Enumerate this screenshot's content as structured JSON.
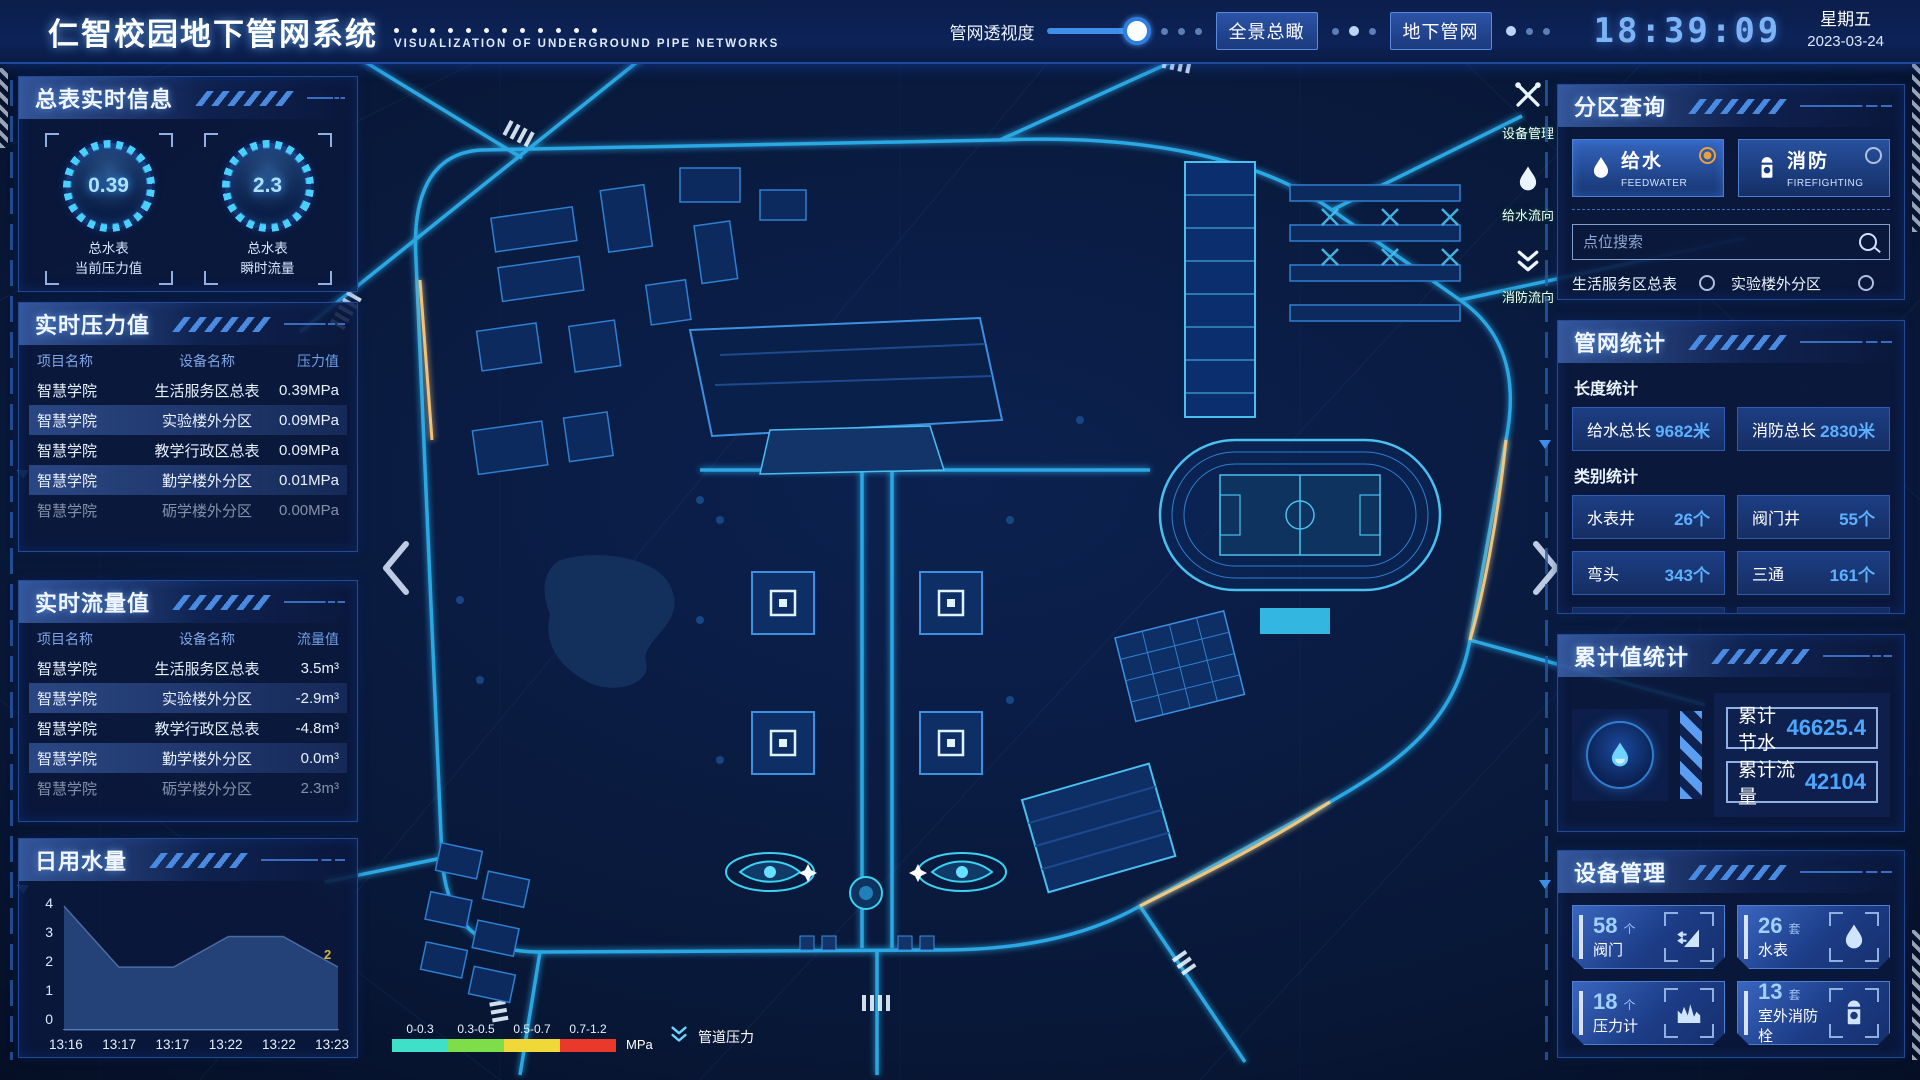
{
  "header": {
    "title": "仁智校园地下管网系统",
    "subtitle": "VISUALIZATION OF UNDERGROUND PIPE NETWORKS",
    "transparency_label": "管网透视度",
    "btn_overview": "全景总瞰",
    "btn_underground": "地下管网",
    "time": "18:39:09",
    "weekday": "星期五",
    "date": "2023-03-24"
  },
  "meter_panel": {
    "title": "总表实时信息",
    "gauges": [
      {
        "value": "0.39",
        "label1": "总水表",
        "label2": "当前压力值"
      },
      {
        "value": "2.3",
        "label1": "总水表",
        "label2": "瞬时流量"
      }
    ]
  },
  "pressure_panel": {
    "title": "实时压力值",
    "headers": [
      "项目名称",
      "设备名称",
      "压力值"
    ],
    "rows": [
      {
        "project": "智慧学院",
        "device": "生活服务区总表",
        "value": "0.39MPa"
      },
      {
        "project": "智慧学院",
        "device": "实验楼外分区",
        "value": "0.09MPa"
      },
      {
        "project": "智慧学院",
        "device": "教学行政区总表",
        "value": "0.09MPa"
      },
      {
        "project": "智慧学院",
        "device": "勤学楼外分区",
        "value": "0.01MPa"
      },
      {
        "project": "智慧学院",
        "device": "砺学楼外分区",
        "value": "0.00MPa"
      }
    ]
  },
  "flow_panel": {
    "title": "实时流量值",
    "headers": [
      "项目名称",
      "设备名称",
      "流量值"
    ],
    "rows": [
      {
        "project": "智慧学院",
        "device": "生活服务区总表",
        "value": "3.5m³"
      },
      {
        "project": "智慧学院",
        "device": "实验楼外分区",
        "value": "-2.9m³"
      },
      {
        "project": "智慧学院",
        "device": "教学行政区总表",
        "value": "-4.8m³"
      },
      {
        "project": "智慧学院",
        "device": "勤学楼外分区",
        "value": "0.0m³"
      },
      {
        "project": "智慧学院",
        "device": "砺学楼外分区",
        "value": "2.3m³"
      }
    ]
  },
  "daily_panel": {
    "title": "日用水量"
  },
  "chart_data": {
    "type": "area",
    "title": "日用水量",
    "x": [
      "13:16",
      "13:17",
      "13:17",
      "13:22",
      "13:22",
      "13:23"
    ],
    "values": [
      4,
      2,
      2,
      3,
      3,
      2
    ],
    "ylim": [
      0,
      4
    ],
    "yticks": [
      0,
      1,
      2,
      3,
      4
    ],
    "last_point_label": "2",
    "grid": false,
    "legend_position": "none",
    "area_color": "#27477e",
    "label_color": "#d4b63e"
  },
  "zone_panel": {
    "title": "分区查询",
    "tabs": [
      {
        "label": "给水",
        "sub": "FEEDWATER",
        "icon": "water-drop-icon",
        "selected": true
      },
      {
        "label": "消防",
        "sub": "FIREFIGHTING",
        "icon": "hydrant-icon",
        "selected": false
      }
    ],
    "search_placeholder": "点位搜索",
    "items": [
      "生活服务区总表",
      "实验楼外分区",
      "教学行政区总表",
      "勤学楼外分区",
      "砺学楼外分区",
      "宿舍区泵房"
    ]
  },
  "stats_panel": {
    "title": "管网统计",
    "length_title": "长度统计",
    "length_stats": [
      {
        "label": "给水总长",
        "value": "9682米"
      },
      {
        "label": "消防总长",
        "value": "2830米"
      }
    ],
    "category_title": "类别统计",
    "category_stats": [
      {
        "label": "水表井",
        "value": "26个"
      },
      {
        "label": "阀门井",
        "value": "55个"
      },
      {
        "label": "弯头",
        "value": "343个"
      },
      {
        "label": "三通",
        "value": "161个"
      }
    ]
  },
  "cumulative_panel": {
    "title": "累计值统计",
    "icon": "water-drop-icon",
    "rows": [
      {
        "label": "累计节水",
        "value": "46625.4"
      },
      {
        "label": "累计流量",
        "value": "42104"
      }
    ]
  },
  "device_panel": {
    "title": "设备管理",
    "cards": [
      {
        "count": "58",
        "unit": "个",
        "label": "阀门",
        "icon": "valve-icon"
      },
      {
        "count": "26",
        "unit": "套",
        "label": "水表",
        "icon": "water-meter-icon"
      },
      {
        "count": "18",
        "unit": "个",
        "label": "压力计",
        "icon": "pressure-gauge-icon"
      },
      {
        "count": "13",
        "unit": "套",
        "label": "室外消防栓",
        "icon": "hydrant-icon"
      }
    ]
  },
  "map_tools": {
    "items": [
      {
        "label": "设备管理",
        "icon": "tools-icon"
      },
      {
        "label": "给水流向",
        "icon": "water-drop-icon"
      },
      {
        "label": "消防流向",
        "icon": "double-chevron-down-icon"
      }
    ]
  },
  "legend": {
    "ranges": [
      {
        "label": "0-0.3",
        "color": "#3fe0c8"
      },
      {
        "label": "0.3-0.5",
        "color": "#7ede4a"
      },
      {
        "label": "0.5-0.7",
        "color": "#f0d838"
      },
      {
        "label": "0.7-1.2",
        "color": "#e8392a"
      }
    ],
    "unit": "MPa",
    "pipe_pressure_label": "管道压力",
    "icon": "double-chevron-down-icon"
  },
  "colors": {
    "accent": "#4da6ff",
    "panel_border": "#24498f",
    "selected_radio": "#e8a23c",
    "time_blue": "#7db4f5",
    "road_glow": "#2fb4f2"
  }
}
